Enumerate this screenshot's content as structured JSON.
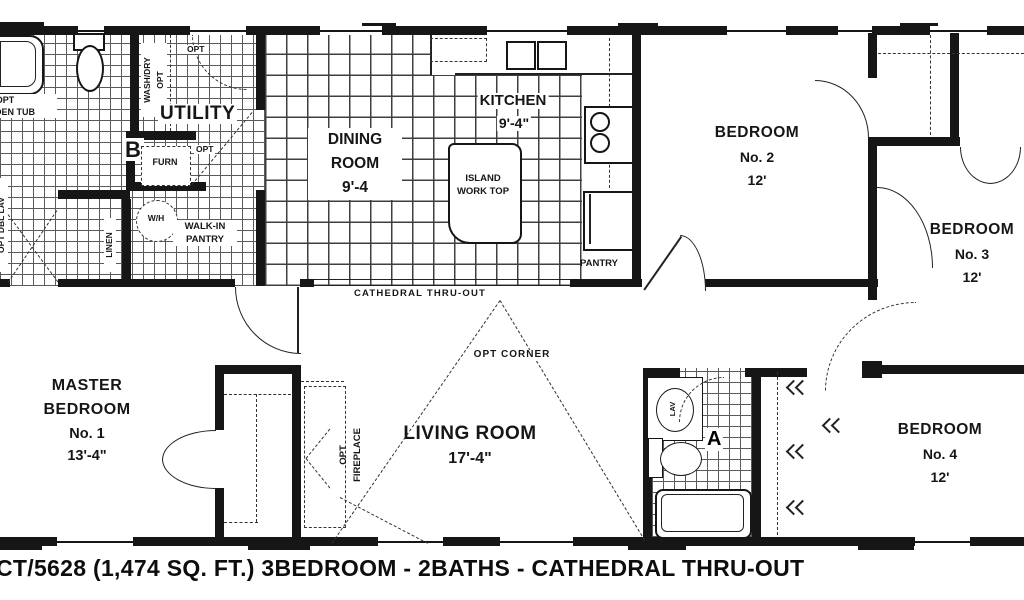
{
  "caption": "CT/5628 (1,474 SQ. FT.) 3BEDROOM - 2BATHS - CATHEDRAL THRU-OUT",
  "rooms": {
    "bath_b": "B",
    "bath_a": "A",
    "utility": "UTILITY",
    "dining": {
      "l1": "DINING",
      "l2": "ROOM",
      "dim": "9'-4"
    },
    "kitchen": {
      "l1": "KITCHEN",
      "dim": "9'-4\""
    },
    "island": {
      "l1": "ISLAND",
      "l2": "WORK TOP"
    },
    "bedroom2": {
      "l1": "BEDROOM",
      "l2": "No. 2",
      "dim": "12'"
    },
    "bedroom3": {
      "l1": "BEDROOM",
      "l2": "No. 3",
      "dim": "12'"
    },
    "bedroom4": {
      "l1": "BEDROOM",
      "l2": "No. 4",
      "dim": "12'"
    },
    "master": {
      "l1": "MASTER",
      "l2": "BEDROOM",
      "l3": "No. 1",
      "dim": "13'-4\""
    },
    "living": {
      "l1": "LIVING ROOM",
      "dim": "17'-4\""
    }
  },
  "labels": {
    "cathedral": "CATHEDRAL THRU-OUT",
    "opt_corner": "OPT CORNER",
    "fireplace_l1": "OPT",
    "fireplace_l2": "FIREPLACE",
    "garden_tub_l1": "OPT",
    "garden_tub_l2": "GARDEN TUB",
    "dbl_lav": "OPT DBL LAV",
    "washdry_l1": "WASH/DRY",
    "washdry_l2": "OPT",
    "opt_door": "OPT",
    "furn": "FURN",
    "wh": "W/H",
    "linen": "LINEN",
    "pantry_opt": "OPT",
    "walkin_l1": "WALK-IN",
    "walkin_l2": "PANTRY",
    "pantry": "PANTRY",
    "lav": "LAV"
  }
}
